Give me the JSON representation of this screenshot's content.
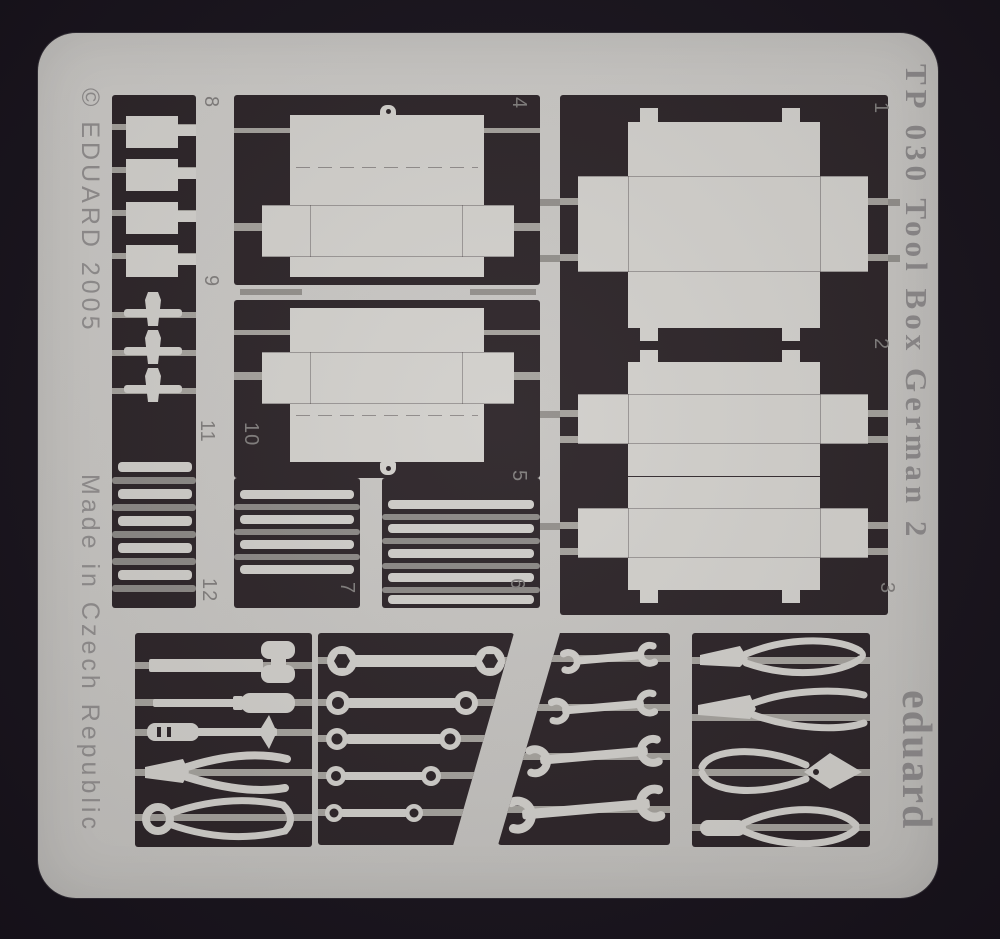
{
  "texts": {
    "copyright": "© EDUARD 2005",
    "origin": "Made in Czech Republic",
    "product": "TP 030 Tool Box German 2",
    "brand": "eduard"
  },
  "labels": {
    "p1": "1",
    "p2": "2",
    "p3": "3",
    "p4": "4",
    "p5": "5",
    "p6": "6",
    "p7": "7",
    "p8": "8",
    "p9": "9",
    "p10": "10",
    "p11": "11",
    "p12": "12"
  },
  "parts_legend": [
    {
      "number": "1",
      "shape": "large toolbox fold-out tray"
    },
    {
      "number": "2",
      "shape": "toolbox half tray with side tabs"
    },
    {
      "number": "3",
      "shape": "toolbox half tray with side tabs"
    },
    {
      "number": "4",
      "shape": "toolbox tray with lid flaps"
    },
    {
      "number": "5",
      "shape": "toolbox tray with lid flaps"
    },
    {
      "number": "6",
      "shape": "thin strips"
    },
    {
      "number": "7",
      "shape": "thin strips"
    },
    {
      "number": "8",
      "shape": "four small plates"
    },
    {
      "number": "9",
      "shape": "three latch pins"
    },
    {
      "number": "10",
      "shape": "strip"
    },
    {
      "number": "11",
      "shape": "thin strips"
    },
    {
      "number": "12",
      "shape": "thin strips"
    }
  ],
  "tool_panels": [
    {
      "tools": [
        "hammer",
        "screwdriver",
        "screwdriver",
        "side-cutter-pliers",
        "ring-pincers"
      ]
    },
    {
      "tools": [
        "ring-wrench",
        "ring-wrench",
        "ring-wrench",
        "ring-wrench",
        "ring-wrench"
      ]
    },
    {
      "tools": [
        "open-end-wrench",
        "open-end-wrench",
        "open-end-wrench",
        "open-end-wrench"
      ]
    },
    {
      "tools": [
        "flat-pliers",
        "long-nose-pliers",
        "pincers",
        "flat-pliers"
      ]
    }
  ],
  "colors": {
    "background": "#17121b",
    "sheet": "#c6c4c1",
    "etched_dark": "#2b2327",
    "part_metal": "#d1cfcb",
    "half_etch": "#a3a09b",
    "engraved_text": "#8f8c8c"
  }
}
